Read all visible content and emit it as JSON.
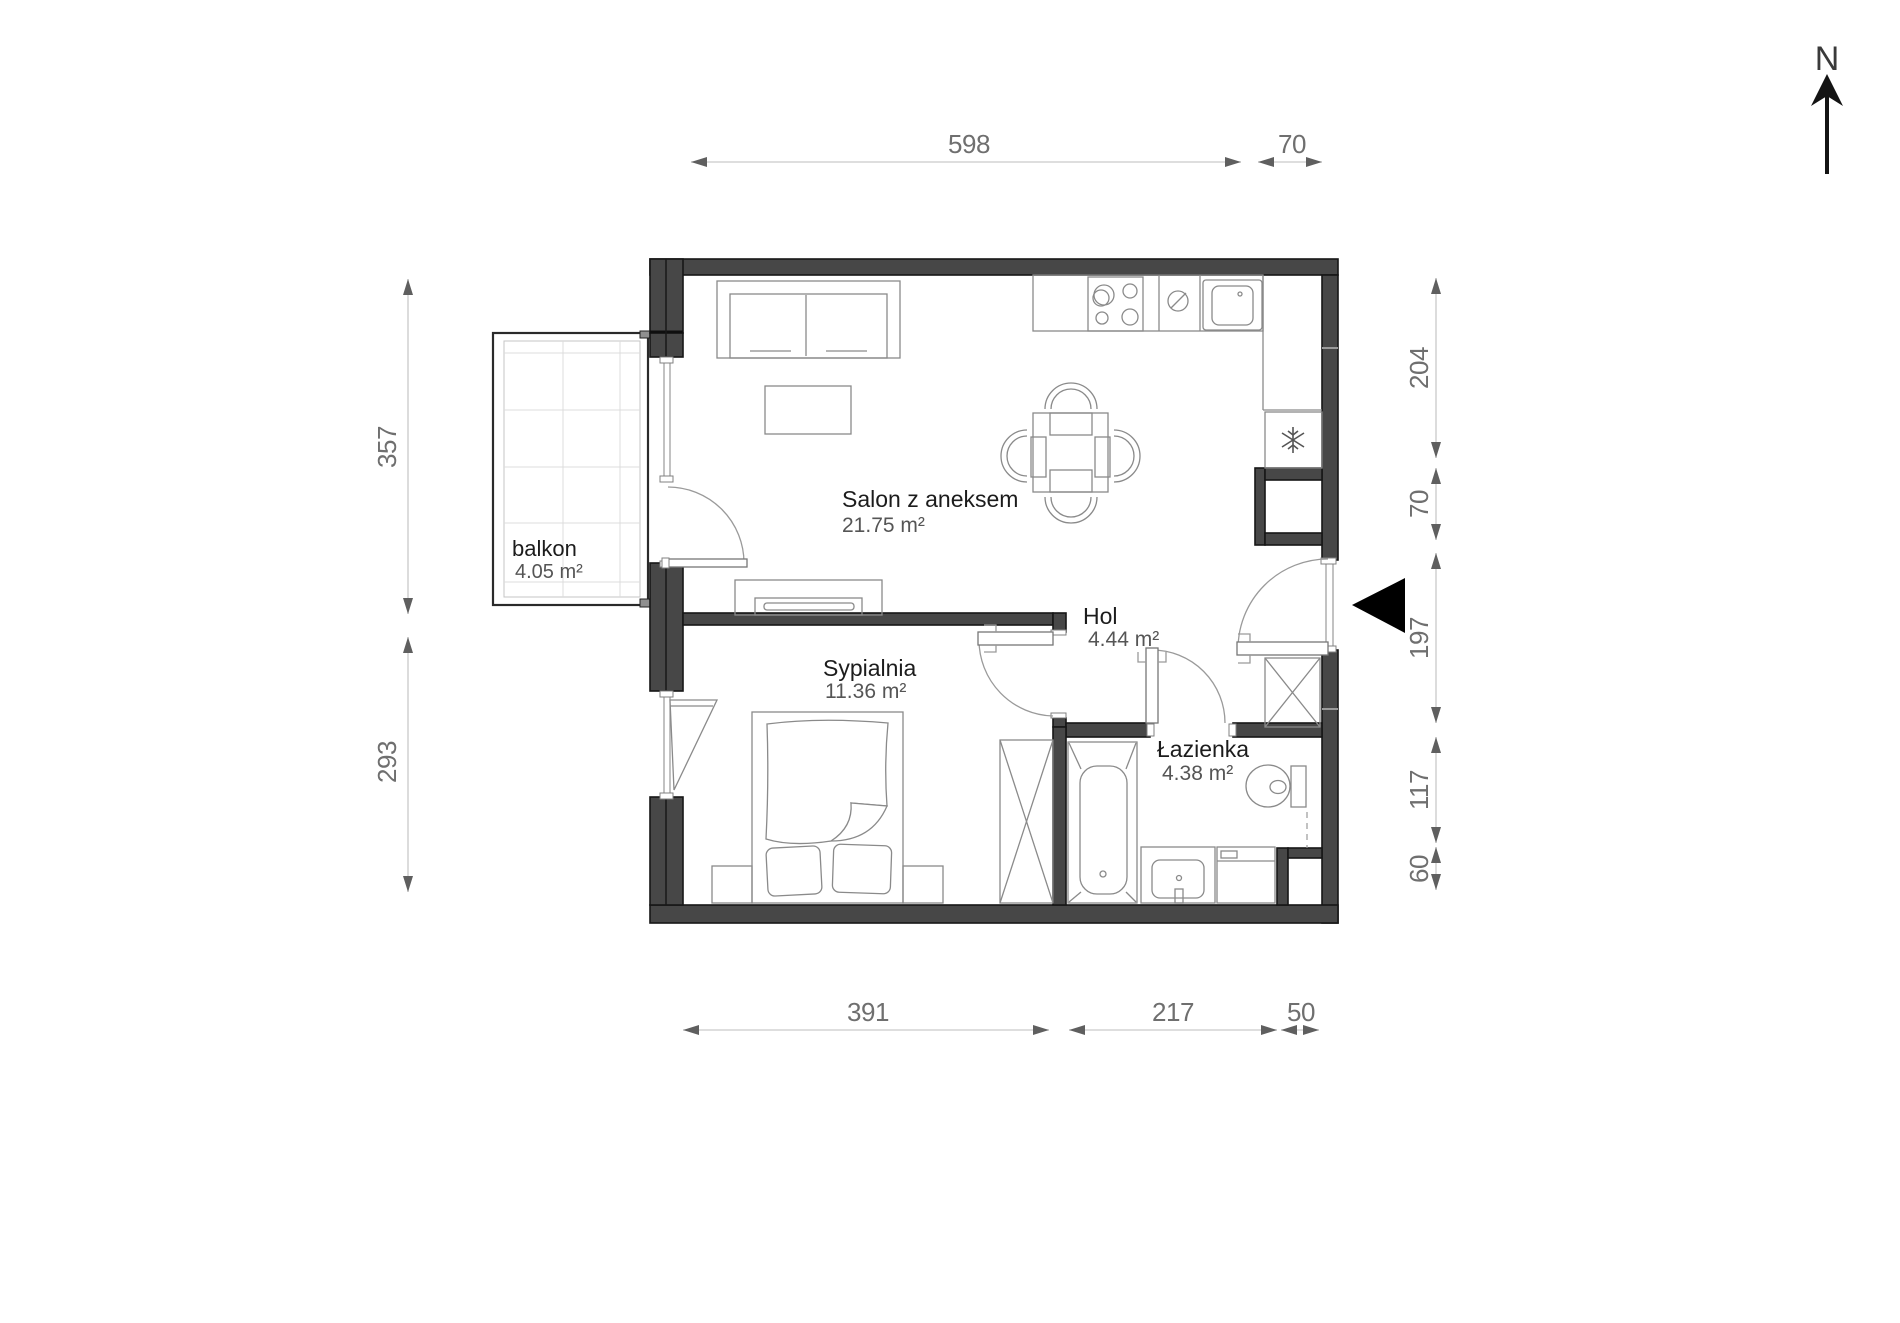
{
  "north": {
    "label": "N"
  },
  "rooms": {
    "salon": {
      "name": "Salon z aneksem",
      "area": "21.75 m²"
    },
    "sypialnia": {
      "name": "Sypialnia",
      "area": "11.36 m²"
    },
    "hol": {
      "name": "Hol",
      "area": "4.44 m²"
    },
    "lazienka": {
      "name": "Łazienka",
      "area": "4.38 m²"
    },
    "balkon": {
      "name": "balkon",
      "area": "4.05 m²"
    }
  },
  "dimensions": {
    "top": [
      "598",
      "70"
    ],
    "bottom": [
      "391",
      "217",
      "50"
    ],
    "left": [
      "357",
      "293"
    ],
    "right": [
      "204",
      "70",
      "197",
      "117",
      "60"
    ]
  },
  "colors": {
    "wall": "#474747",
    "wall_outline": "#161616",
    "furniture_line": "#8a8a8a",
    "dimension_line": "#c9c9c9",
    "dimension_text": "#6f6f6f",
    "room_text": "#1c1c1c",
    "area_text": "#555555",
    "entrance_marker": "#000000"
  }
}
